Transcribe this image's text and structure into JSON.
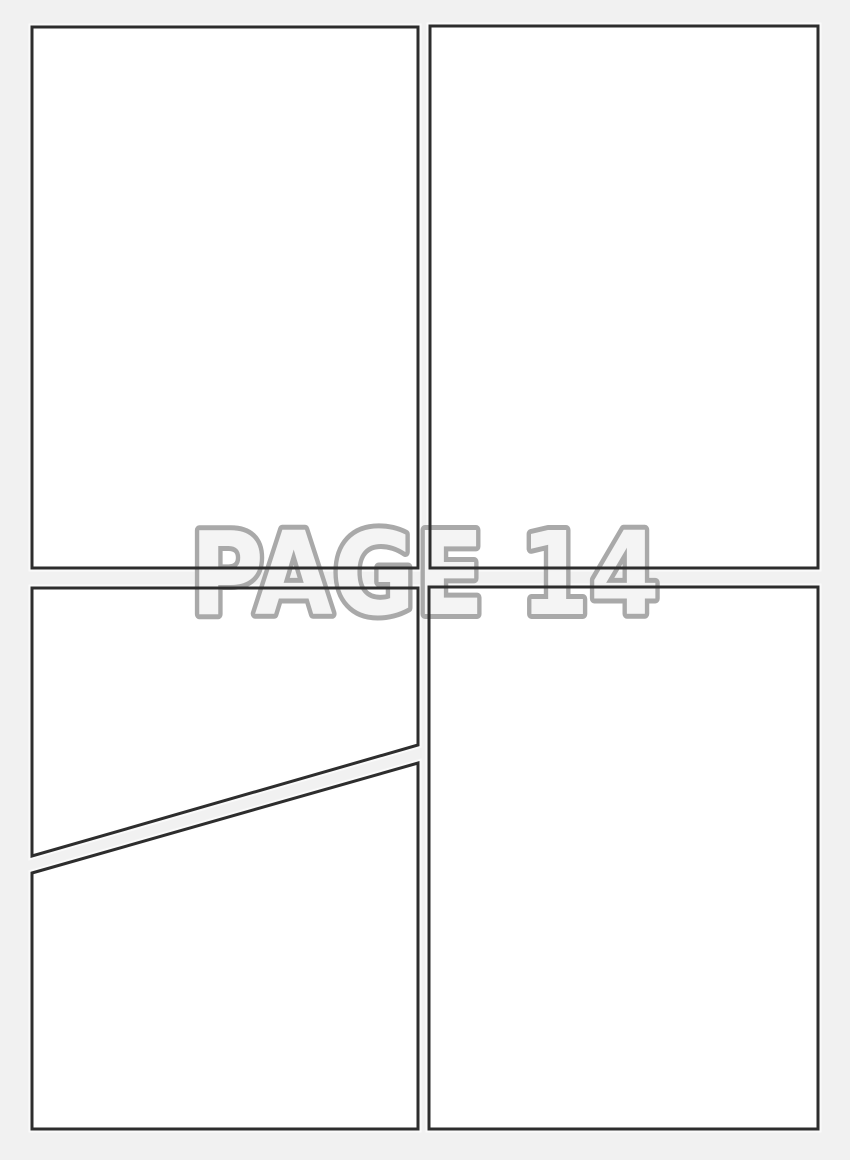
{
  "page": {
    "watermark": "PAGE 14",
    "page_number": "14"
  },
  "colors": {
    "background": "#f1f1f1",
    "panel_fill": "#ffffff",
    "panel_halo": "#fafafa",
    "panel_border": "#2d2d2d",
    "watermark_fill": "#f4f4f4",
    "watermark_stroke": "#a9a9a9"
  }
}
